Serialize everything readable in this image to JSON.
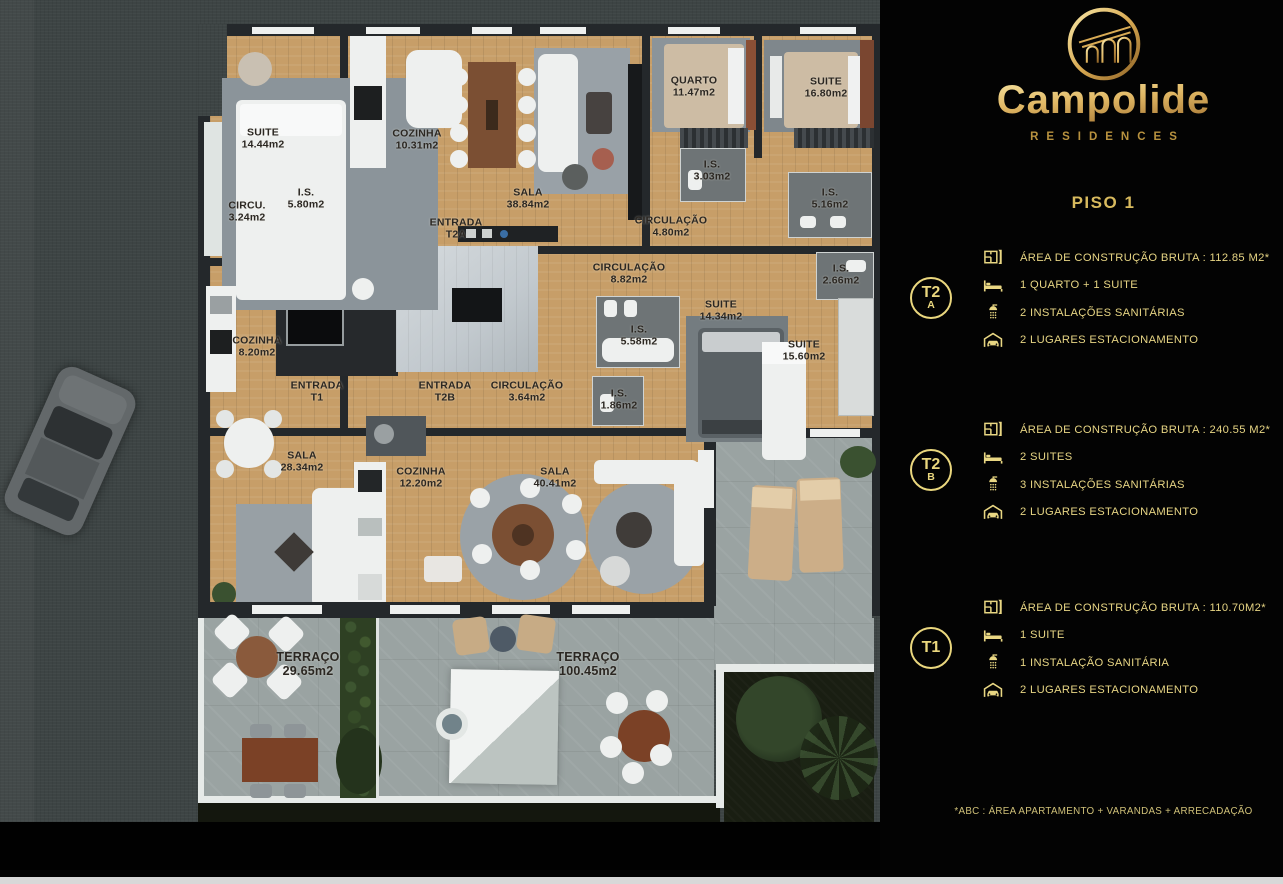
{
  "brand": {
    "name": "Campolide",
    "subtitle": "RESIDENCES",
    "floor_label": "PISO 1"
  },
  "panel": {
    "units": [
      {
        "badge_main": "T2",
        "badge_sub": "A",
        "rows": [
          {
            "icon": "floorplan-icon",
            "text": "ÁREA DE CONSTRUÇÃO BRUTA :  112.85 M2*"
          },
          {
            "icon": "bed-icon",
            "text": "1 QUARTO + 1 SUITE"
          },
          {
            "icon": "shower-icon",
            "text": "2 INSTALAÇÕES SANITÁRIAS"
          },
          {
            "icon": "parking-icon",
            "text": "2 LUGARES ESTACIONAMENTO"
          }
        ]
      },
      {
        "badge_main": "T2",
        "badge_sub": "B",
        "rows": [
          {
            "icon": "floorplan-icon",
            "text": "ÁREA DE CONSTRUÇÃO BRUTA :  240.55 M2*"
          },
          {
            "icon": "bed-icon",
            "text": "2 SUITES"
          },
          {
            "icon": "shower-icon",
            "text": "3 INSTALAÇÕES SANITÁRIAS"
          },
          {
            "icon": "parking-icon",
            "text": "2 LUGARES ESTACIONAMENTO"
          }
        ]
      },
      {
        "badge_main": "T1",
        "badge_sub": "",
        "rows": [
          {
            "icon": "floorplan-icon",
            "text": "ÁREA DE CONSTRUÇÃO BRUTA :  110.70M2*"
          },
          {
            "icon": "bed-icon",
            "text": "1 SUITE"
          },
          {
            "icon": "shower-icon",
            "text": "1 INSTALAÇÃO SANITÁRIA"
          },
          {
            "icon": "parking-icon",
            "text": "2 LUGARES ESTACIONAMENTO"
          }
        ]
      }
    ],
    "footnote": "*ABC :  ÁREA APARTAMENTO + VARANDAS + ARRECADAÇÃO"
  },
  "colors": {
    "gold": "#e9d783",
    "gold_deep": "#8f6326",
    "panel_bg": "#030303",
    "wood": "#c79e68",
    "wall": "#24282b",
    "concrete": "#9aa3a2",
    "street": "#3d4444",
    "hedge": "#2e4023",
    "white": "#eef0ef"
  },
  "floorplan": {
    "rooms": [
      {
        "name": "SUITE",
        "detail": "14.44m2",
        "x": 263,
        "y": 139
      },
      {
        "name": "COZINHA",
        "detail": "10.31m2",
        "x": 417,
        "y": 140
      },
      {
        "name": "CIRCU.",
        "detail": "3.24m2",
        "x": 247,
        "y": 212
      },
      {
        "name": "I.S.",
        "detail": "5.80m2",
        "x": 306,
        "y": 199
      },
      {
        "name": "ENTRADA",
        "detail": "T2A",
        "x": 456,
        "y": 229
      },
      {
        "name": "SALA",
        "detail": "38.84m2",
        "x": 528,
        "y": 199
      },
      {
        "name": "QUARTO",
        "detail": "11.47m2",
        "x": 694,
        "y": 87
      },
      {
        "name": "SUITE",
        "detail": "16.80m2",
        "x": 826,
        "y": 88
      },
      {
        "name": "I.S.",
        "detail": "3.03m2",
        "x": 712,
        "y": 171
      },
      {
        "name": "I.S.",
        "detail": "5.16m2",
        "x": 830,
        "y": 199
      },
      {
        "name": "CIRCULAÇÃO",
        "detail": "4.80m2",
        "x": 671,
        "y": 227
      },
      {
        "name": "CIRCULAÇÃO",
        "detail": "8.82m2",
        "x": 629,
        "y": 274
      },
      {
        "name": "I.S.",
        "detail": "2.66m2",
        "x": 841,
        "y": 275
      },
      {
        "name": "SUITE",
        "detail": "14.34m2",
        "x": 721,
        "y": 311
      },
      {
        "name": "I.S.",
        "detail": "5.58m2",
        "x": 639,
        "y": 336
      },
      {
        "name": "SUITE",
        "detail": "15.60m2",
        "x": 804,
        "y": 351
      },
      {
        "name": "I.S.",
        "detail": "1.86m2",
        "x": 619,
        "y": 400
      },
      {
        "name": "COZINHA",
        "detail": "8.20m2",
        "x": 257,
        "y": 347
      },
      {
        "name": "ENTRADA",
        "detail": "T1",
        "x": 317,
        "y": 392
      },
      {
        "name": "ENTRADA",
        "detail": "T2B",
        "x": 445,
        "y": 392
      },
      {
        "name": "CIRCULAÇÃO",
        "detail": "3.64m2",
        "x": 527,
        "y": 392
      },
      {
        "name": "SALA",
        "detail": "28.34m2",
        "x": 302,
        "y": 462
      },
      {
        "name": "COZINHA",
        "detail": "12.20m2",
        "x": 421,
        "y": 478
      },
      {
        "name": "SALA",
        "detail": "40.41m2",
        "x": 555,
        "y": 478
      },
      {
        "name": "TERRAÇO",
        "detail": "29.65m2",
        "x": 308,
        "y": 664,
        "size": 12.5
      },
      {
        "name": "TERRAÇO",
        "detail": "100.45m2",
        "x": 588,
        "y": 664,
        "size": 12.5
      }
    ]
  }
}
